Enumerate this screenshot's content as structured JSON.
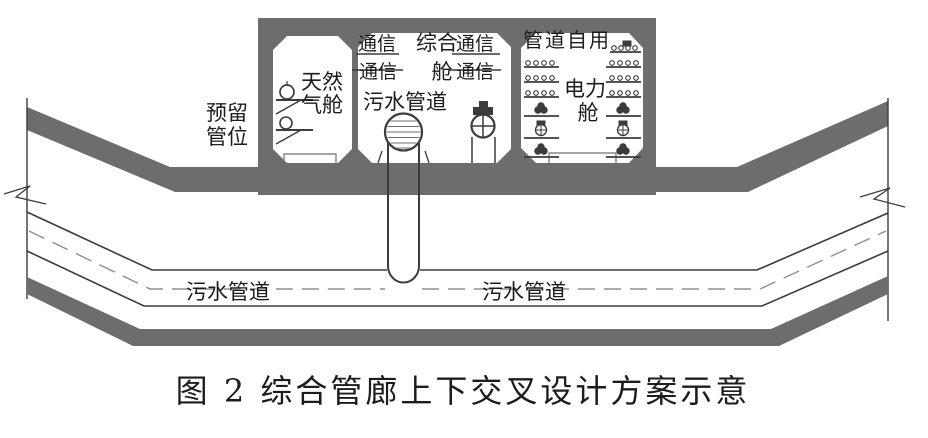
{
  "colors": {
    "band": "#6d6d6d",
    "line": "#3b3b3b",
    "text": "#1c1c1c",
    "centerline": "#8f8f8f"
  },
  "labels": {
    "reserved_line1": "预留",
    "reserved_line2": "管位"
  },
  "compartments": {
    "gas": {
      "name_line1": "天然",
      "name_line2": "气舱"
    },
    "utility": {
      "comm_top_left": "通信",
      "comm_bottom_left": "通信",
      "comm_top_right": "通信",
      "comm_bottom_right": "通信",
      "name_line1": "综合",
      "name_line2": "舱",
      "sewage_pipe_label": "污水管道"
    },
    "power": {
      "top_label": "管道自用",
      "name_line1": "电力",
      "name_line2": "舱"
    }
  },
  "lower_pipe": {
    "label_left": "污水管道",
    "label_right": "污水管道"
  },
  "caption": "图 2  综合管廊上下交叉设计方案示意"
}
